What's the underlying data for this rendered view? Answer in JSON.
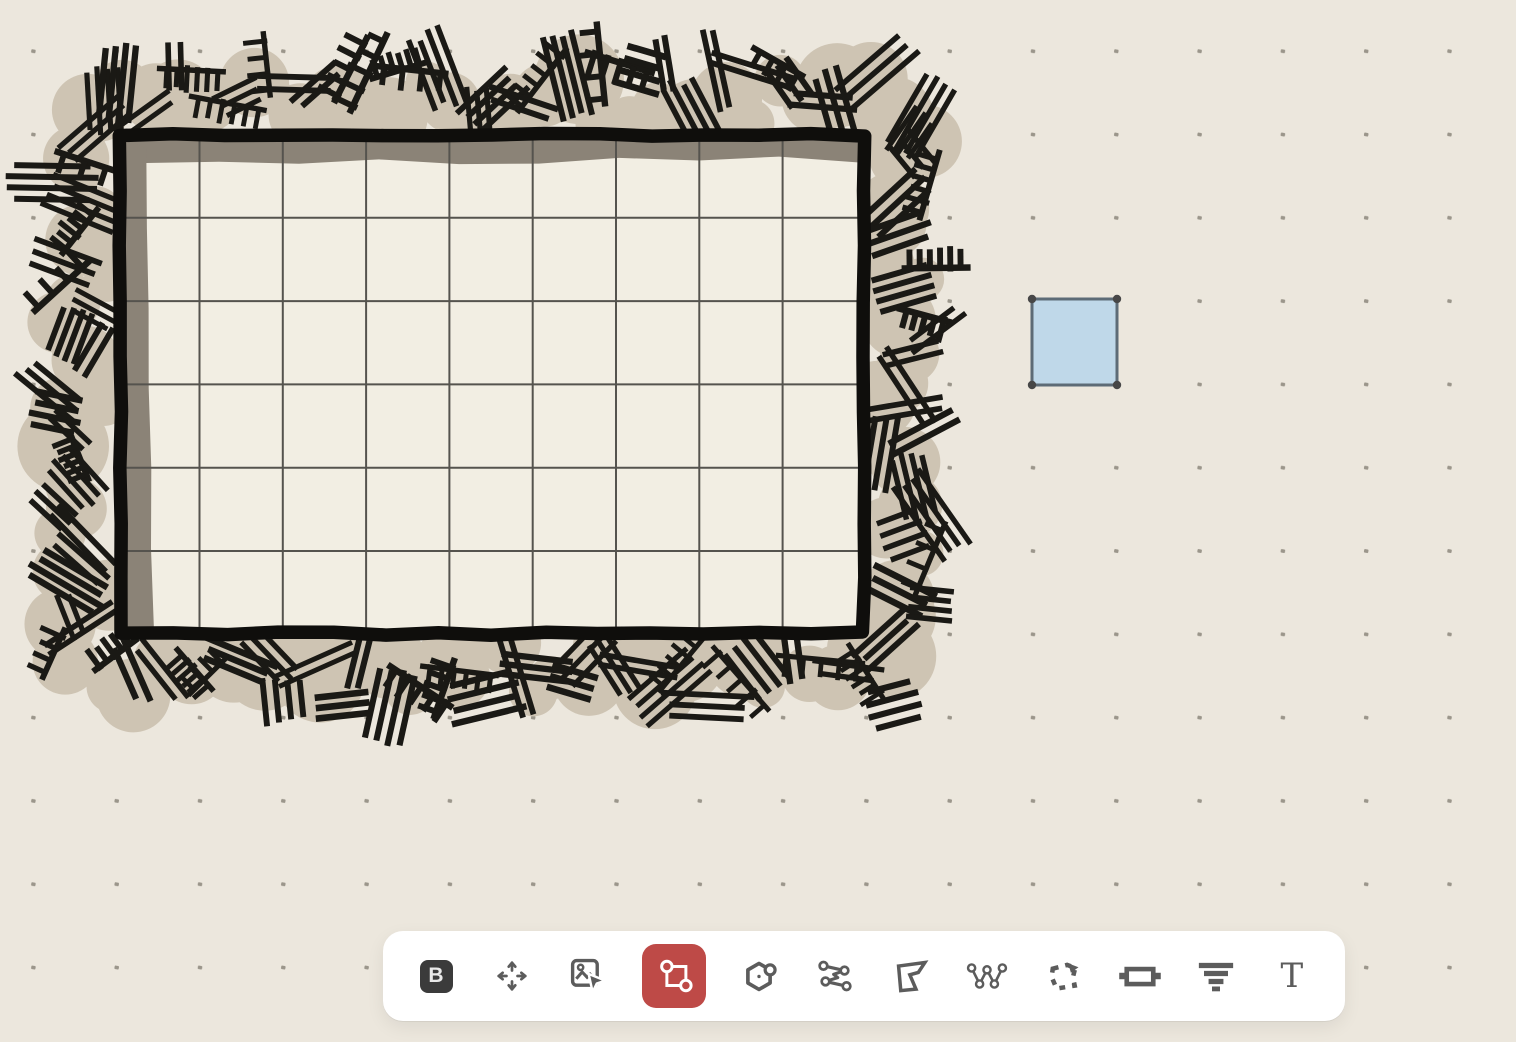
{
  "colors": {
    "background": "#ECE7DD",
    "dot": "#9B968B",
    "hatch_ink": "#1A1915",
    "hatch_wash": "#CEC4B3",
    "wall": "#0F0E0C",
    "floor": "#F2EEE3",
    "wall_shadow": "#8B8377",
    "grid_line": "#55534E",
    "marker_fill": "#BFD8E9",
    "marker_stroke": "#5D6B76",
    "marker_node": "#474747",
    "toolbar_bg": "#FFFFFF",
    "icon": "#5C5C5C",
    "active_tool_bg": "#BE4A47",
    "active_tool_icon": "#FFFFFF",
    "brand_bg": "#3B3B3B",
    "brand_fg": "#E9E9E9"
  },
  "canvas": {
    "grid_spacing": 83.3,
    "dot_origin": {
      "x": 33.2,
      "y": 51.2
    },
    "room": {
      "wall_rect": {
        "x": 120,
        "y": 134.5,
        "width": 744,
        "height": 499
      },
      "wall_thickness": 13.5,
      "grid_cols": 9,
      "grid_rows": 6,
      "first_vline_x": 199.5,
      "first_hline_y": 217.8,
      "shadow": {
        "top_depth": 21,
        "left_depth": 25
      }
    },
    "marker": {
      "x": 1032,
      "y": 299,
      "width": 85,
      "height": 86
    }
  },
  "toolbar": {
    "tools": [
      {
        "id": "brand",
        "name": "brand-button",
        "label": "B",
        "active": false
      },
      {
        "id": "move",
        "name": "move-tool",
        "active": false
      },
      {
        "id": "image-select",
        "name": "image-select-tool",
        "active": false
      },
      {
        "id": "transform",
        "name": "transform-select-tool",
        "active": true
      },
      {
        "id": "hexagon",
        "name": "hex-shape-tool",
        "active": false
      },
      {
        "id": "curve",
        "name": "curve-path-tool",
        "active": false
      },
      {
        "id": "polygon",
        "name": "polygon-tool",
        "active": false
      },
      {
        "id": "polyline",
        "name": "polyline-nodes-tool",
        "active": false
      },
      {
        "id": "marquee",
        "name": "freehand-select-tool",
        "active": false
      },
      {
        "id": "door",
        "name": "door-tool",
        "active": false
      },
      {
        "id": "funnel",
        "name": "funnel-tool",
        "active": false
      },
      {
        "id": "text",
        "name": "text-tool",
        "label": "T",
        "active": false
      }
    ]
  }
}
